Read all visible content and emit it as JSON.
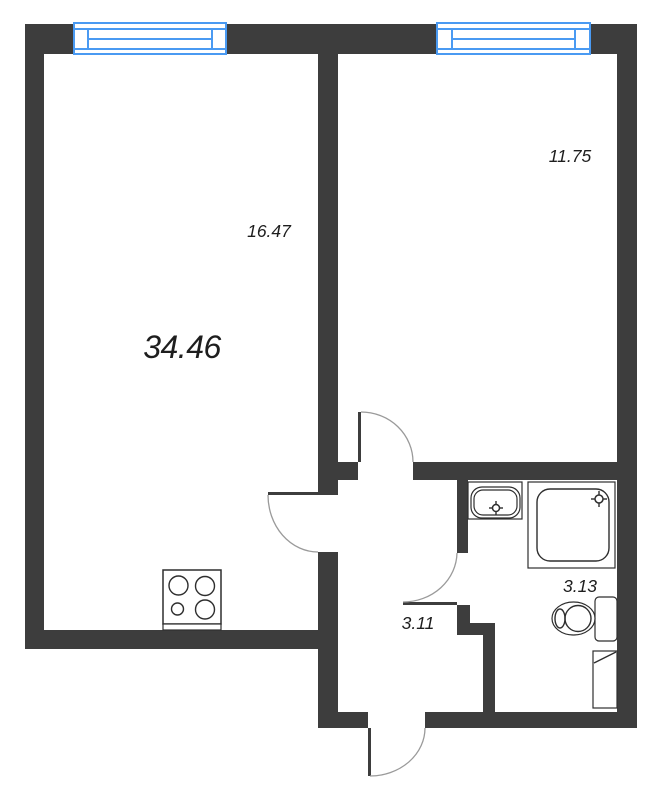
{
  "colors": {
    "wall": "#3d3d3d",
    "window": "#4a9af2",
    "outline": "#2e2e2e",
    "arc": "#9a9a9a",
    "text": "#1e1e1e",
    "bg": "#ffffff"
  },
  "labels": {
    "total_area": "34.46",
    "living_kitchen": "16.47",
    "bedroom": "11.75",
    "hallway": "3.11",
    "bathroom": "3.13"
  },
  "icons": {
    "stove": "stove-4-burner-icon",
    "sink": "washbasin-icon",
    "shower": "shower-tray-icon",
    "toilet": "toilet-icon",
    "window": "window-icon",
    "door": "door-swing-icon"
  }
}
